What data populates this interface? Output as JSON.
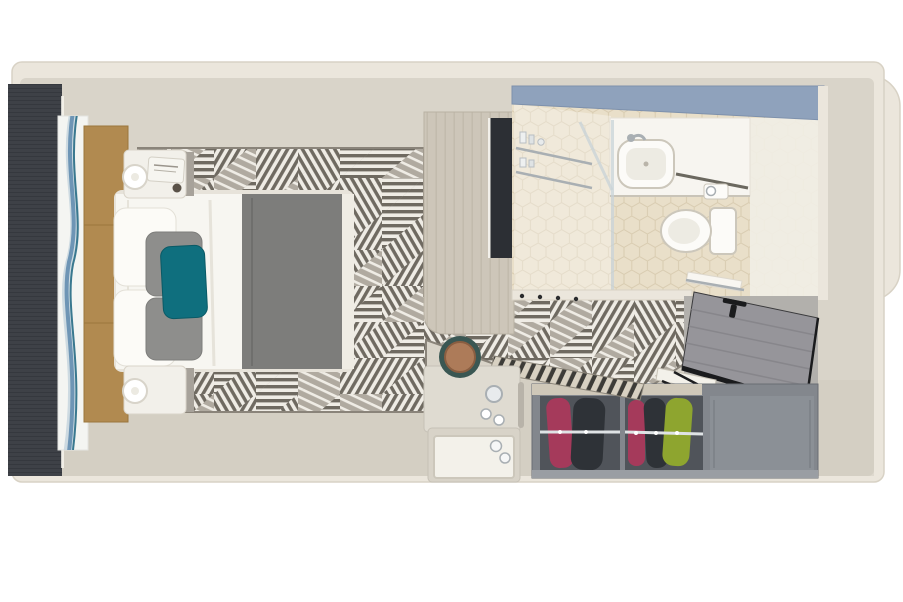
{
  "scene": {
    "name": "cruise-stateroom-top-down-3d-floorplan",
    "background": "#ffffff"
  },
  "rooms": {
    "bedroom": "bedroom-with-queen-bed",
    "bathroom": "bathroom-with-shower-sink-toilet",
    "wardrobe_area": "open-wardrobe-and-entry-hall"
  },
  "palette": {
    "wall": "#ebe6dc",
    "wallEdge": "#d8d2c5",
    "floor": "#d9d4c9",
    "floorShade": "#cfc9bd",
    "carpetBase": "#b0aaa0",
    "carpetDark": "#6f6a61",
    "carpetLight": "#efece5",
    "carpetEdge": "#8a847a",
    "darkWall": "#3e4147",
    "darkWallLine": "#35383e",
    "artPanel": "#f4f5f2",
    "artBlue": "#6e95b5",
    "artTeal": "#39788f",
    "artLight": "#c3d3dc",
    "headboard": "#b18a50",
    "headboardSeam": "#9a763c",
    "bedFrame": "#e7e3da",
    "duvet": "#f7f6f1",
    "duvetFold": "#e6e3da",
    "blanket": "#7d7d7b",
    "blanketFold": "#6f6f6d",
    "pillowWhite": "#fcfbf7",
    "pillowGray": "#8e8e8c",
    "pillowTeal": "#0f6f7e",
    "nightstand": "#f2f0ea",
    "nightstandEdge": "#d9d4c9",
    "lamp": "#ffffff",
    "lampEdge": "#d8d4ca",
    "magazine": "#f6f5f0",
    "bottleDark": "#5a5248",
    "cabinetWood": "#cdc6b9",
    "woodGrain": "#c1baac",
    "tv": "#2c2f34",
    "tileFloor": "#e9dfc9",
    "tileLine": "#d9ccb1",
    "showerGlass": "#c8d3d8",
    "mirrorBand": "#8fa2bc",
    "mirrorBandEdge": "#7e91ac",
    "vanity": "#f7f5f0",
    "vanityRight": "#f1eee6",
    "fixtureWhite": "#fcfbf8",
    "fixtureLine": "#ccc7bb",
    "basinInner": "#edebe3",
    "chrome": "#a9afb3",
    "chromeLight": "#e8ebed",
    "entryFloor": "#b2b0ac",
    "door": "#96959a",
    "doorPlank": "#87868b",
    "doorFrame": "#1a1b1d",
    "wardrobe": "#83878d",
    "wardrobeDark": "#50545a",
    "wardrobeEmpty": "#8b9096",
    "wardrobeTop": "#cfc8b9",
    "rail": "#dfe3e5",
    "garmentMagenta": "#a53a5b",
    "garmentDark": "#2e3237",
    "garmentGreen": "#8ea52f",
    "benchBase": "#d8d1c2",
    "benchStripe": "#3d3c38",
    "desk": "#d8d3c8",
    "deskLight": "#dfdbd1",
    "tray": "#f3f1ea",
    "trayEdge": "#ccc7bb",
    "stoolRing": "#3a5753",
    "stoolSeat": "#ad7b59",
    "stoolSeatEdge": "#8a5e41"
  },
  "objects": [
    {
      "name": "feature-wall",
      "color": "#3e4147"
    },
    {
      "name": "abstract-art-panel",
      "color": "#6e95b5"
    },
    {
      "name": "upholstered-headboard",
      "color": "#b18a50"
    },
    {
      "name": "queen-bed",
      "duvet": "#f7f6f1",
      "foot_blanket": "#7d7d7b",
      "accent_pillow": "#0f6f7e"
    },
    {
      "name": "nightstand-with-lamp",
      "count": 2
    },
    {
      "name": "geometric-carpet",
      "colors": [
        "#b0aaa0",
        "#6f6a61",
        "#efece5"
      ]
    },
    {
      "name": "tv-cabinet",
      "tv": "#2c2f34"
    },
    {
      "name": "bathroom",
      "tile": "#e9dfc9",
      "mirror_band": "#8fa2bc",
      "fixtures": [
        "shower",
        "sink",
        "toilet",
        "towel-rail"
      ]
    },
    {
      "name": "entry-door",
      "color": "#96959a"
    },
    {
      "name": "open-wardrobe",
      "garments": [
        "#a53a5b",
        "#2e3237",
        "#8ea52f"
      ],
      "compartments": 3
    },
    {
      "name": "striped-bench-cushion",
      "colors": [
        "#d8d1c2",
        "#3d3c38"
      ]
    },
    {
      "name": "desk-with-kettle-and-tray"
    },
    {
      "name": "round-stool",
      "seat": "#ad7b59"
    }
  ]
}
